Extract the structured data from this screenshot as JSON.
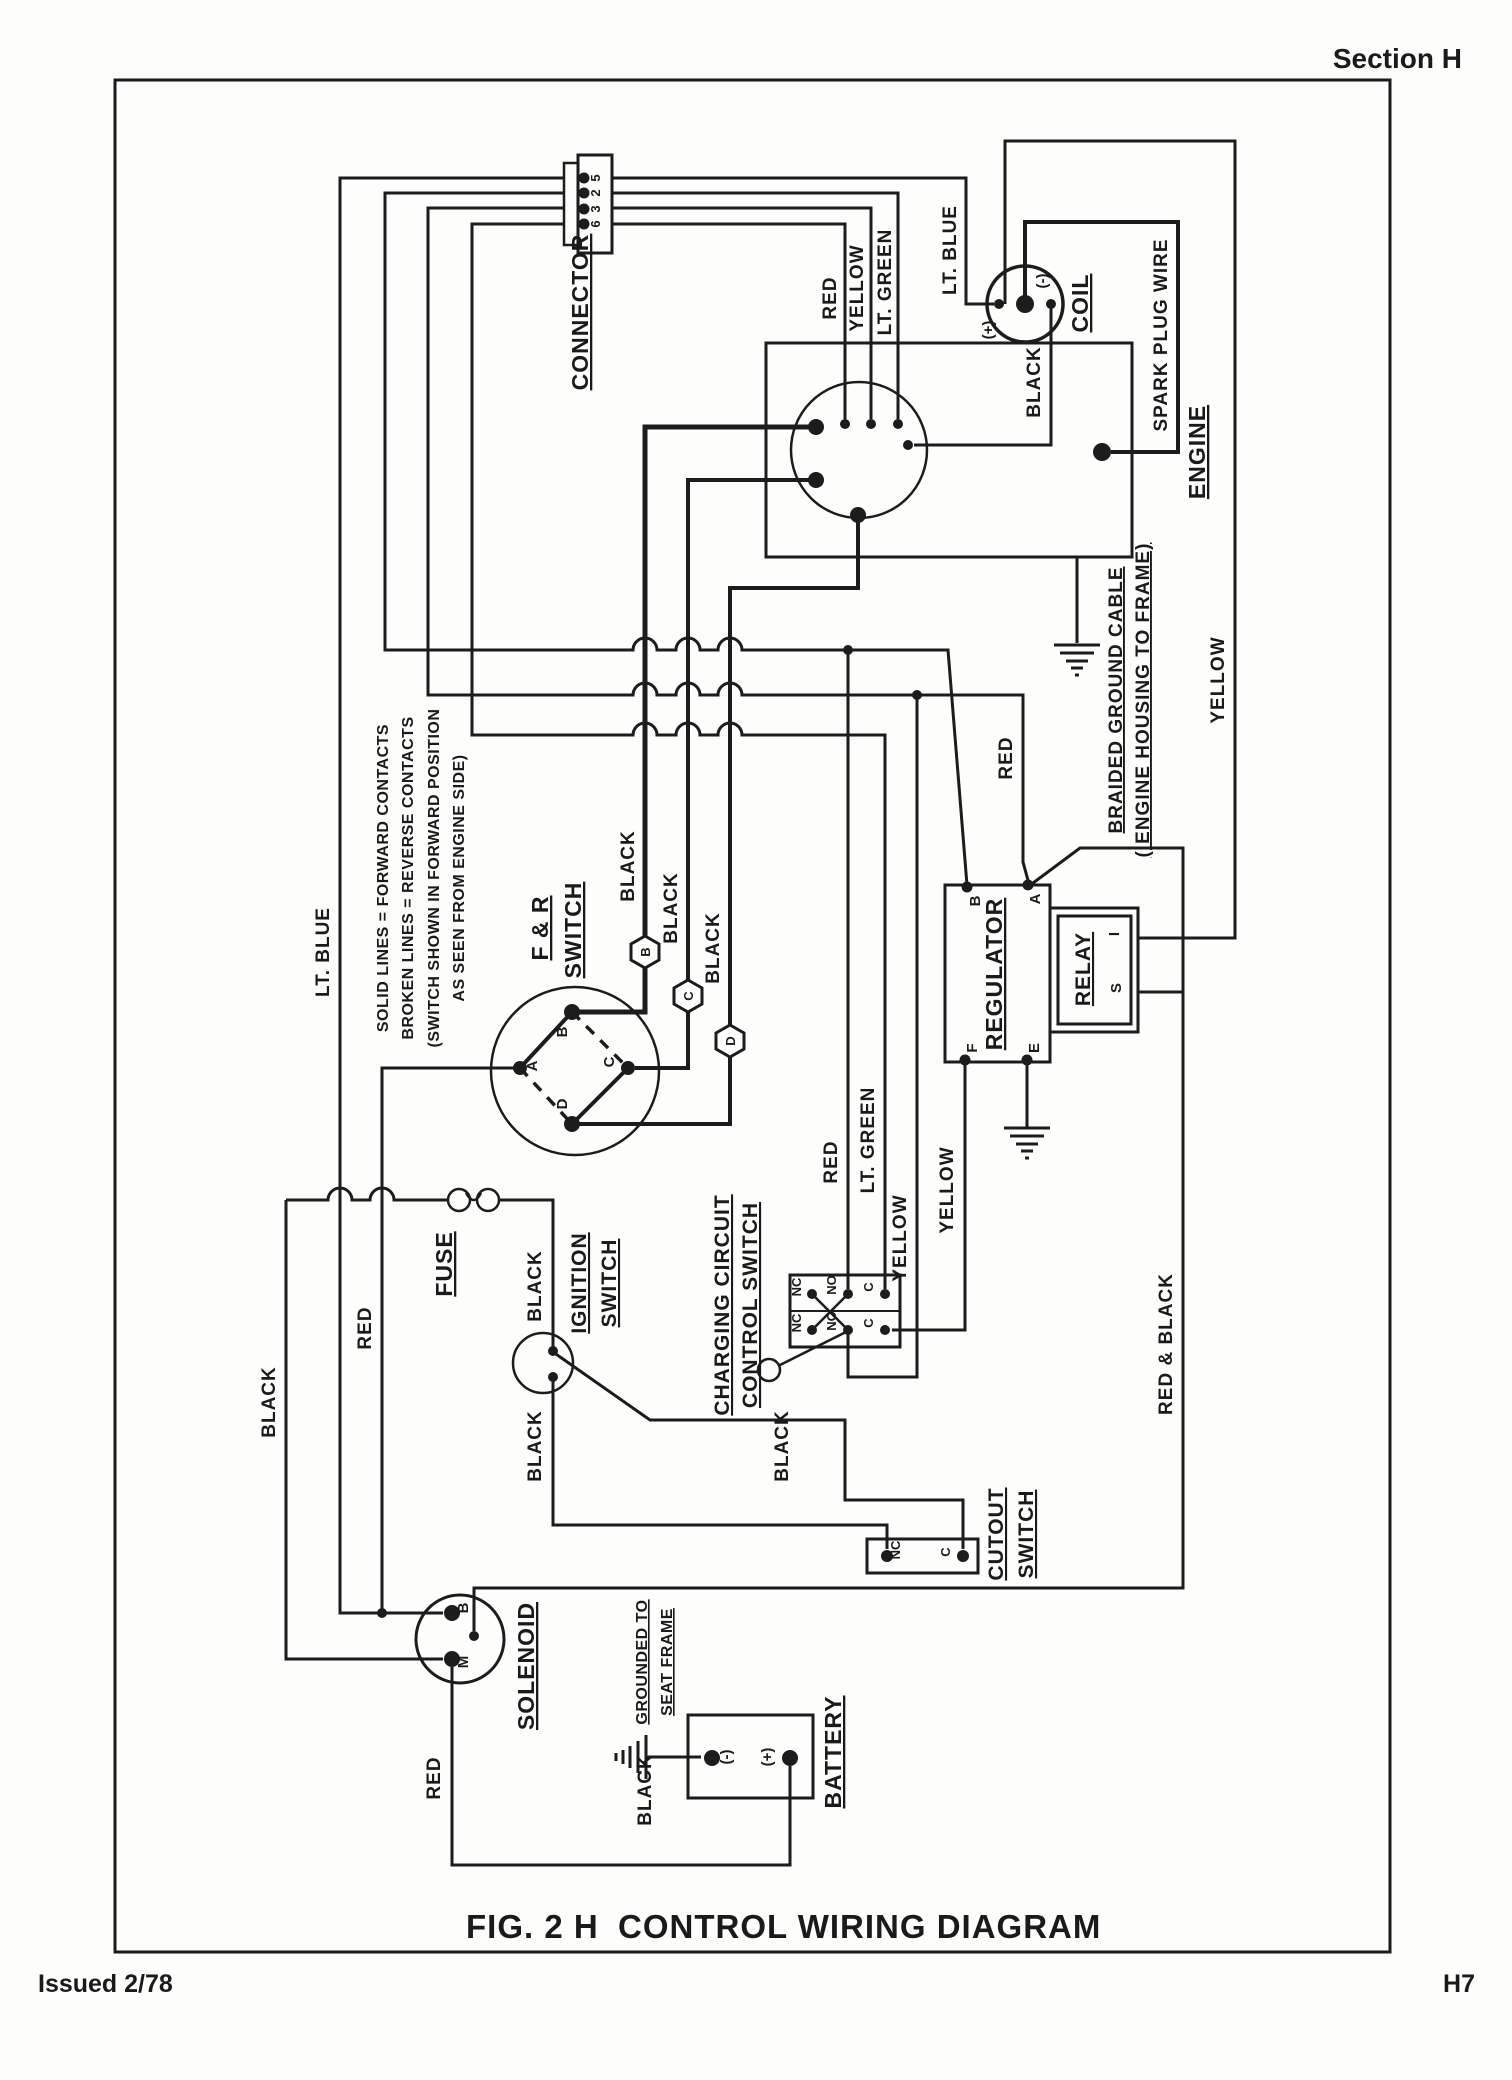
{
  "page": {
    "section": "Section H",
    "issued": "Issued 2/78",
    "page_number": "H7",
    "caption_fig": "FIG. 2 H",
    "caption_title": "CONTROL WIRING DIAGRAM"
  },
  "connector": {
    "label": "CONNECTOR",
    "pin_1": "5",
    "pin_2": "2",
    "pin_3": "3",
    "pin_4": "6"
  },
  "coil": {
    "label": "COIL",
    "plus": "(+)",
    "minus": "(-)"
  },
  "engine": {
    "label": "ENGINE",
    "spark_plug_wire": "SPARK PLUG WIRE",
    "ground_note_line1": "BRAIDED GROUND CABLE",
    "ground_note_line2": "( ENGINE HOUSING TO FRAME)"
  },
  "fr_switch": {
    "label_line1": "F & R",
    "label_line2": "SWITCH",
    "terminal_a": "A",
    "terminal_b": "B",
    "terminal_c": "C",
    "terminal_d": "D",
    "hex_b": "B",
    "hex_c": "C",
    "hex_d": "D",
    "notes": [
      "SOLID LINES = FORWARD CONTACTS",
      "BROKEN LINES = REVERSE CONTACTS",
      "(SWITCH SHOWN IN FORWARD POSITION",
      "AS SEEN FROM ENGINE SIDE)"
    ]
  },
  "regulator": {
    "label": "REGULATOR",
    "terminal_b": "B",
    "terminal_a": "A",
    "terminal_f": "F",
    "terminal_e": "E"
  },
  "relay": {
    "label": "RELAY",
    "terminal_i": "I",
    "terminal_s": "S"
  },
  "charging_switch": {
    "label_line1": "CHARGING CIRCUIT",
    "label_line2": "CONTROL SWITCH",
    "row1_nc": "NC",
    "row1_no": "NO",
    "row1_c": "C",
    "row2_nc": "NC",
    "row2_no": "NO",
    "row2_c": "C"
  },
  "ignition_switch": {
    "label_line1": "IGNITION",
    "label_line2": "SWITCH"
  },
  "fuse": {
    "label": "FUSE"
  },
  "cutout_switch": {
    "label_line1": "CUTOUT",
    "label_line2": "SWITCH",
    "terminal_nc": "NC",
    "terminal_c": "C"
  },
  "solenoid": {
    "label": "SOLENOID",
    "terminal_b": "B",
    "terminal_m": "M"
  },
  "battery": {
    "label": "BATTERY",
    "minus": "(-)",
    "plus": "(+)",
    "ground_note_line1": "GROUNDED TO",
    "ground_note_line2": "SEAT FRAME"
  },
  "wire_labels": {
    "red_top": "RED",
    "yellow_top": "YELLOW",
    "lt_green_top": "LT. GREEN",
    "lt_blue_top": "LT. BLUE",
    "black_coil": "BLACK",
    "yellow_right": "YELLOW",
    "lt_blue_left": "LT. BLUE",
    "black_hex_b": "BLACK",
    "black_hex_c": "BLACK",
    "black_hex_d": "BLACK",
    "red_regulator": "RED",
    "red_charging": "RED",
    "lt_green_charging": "LT. GREEN",
    "yellow_regulator_f": "YELLOW",
    "yellow_charging": "YELLOW",
    "red_and_black": "RED & BLACK",
    "black_left": "BLACK",
    "red_left": "RED",
    "black_ignition_top": "BLACK",
    "black_ignition_bottom": "BLACK",
    "black_cutout_feed": "BLACK",
    "red_solenoid": "RED",
    "black_battery": "BLACK"
  }
}
